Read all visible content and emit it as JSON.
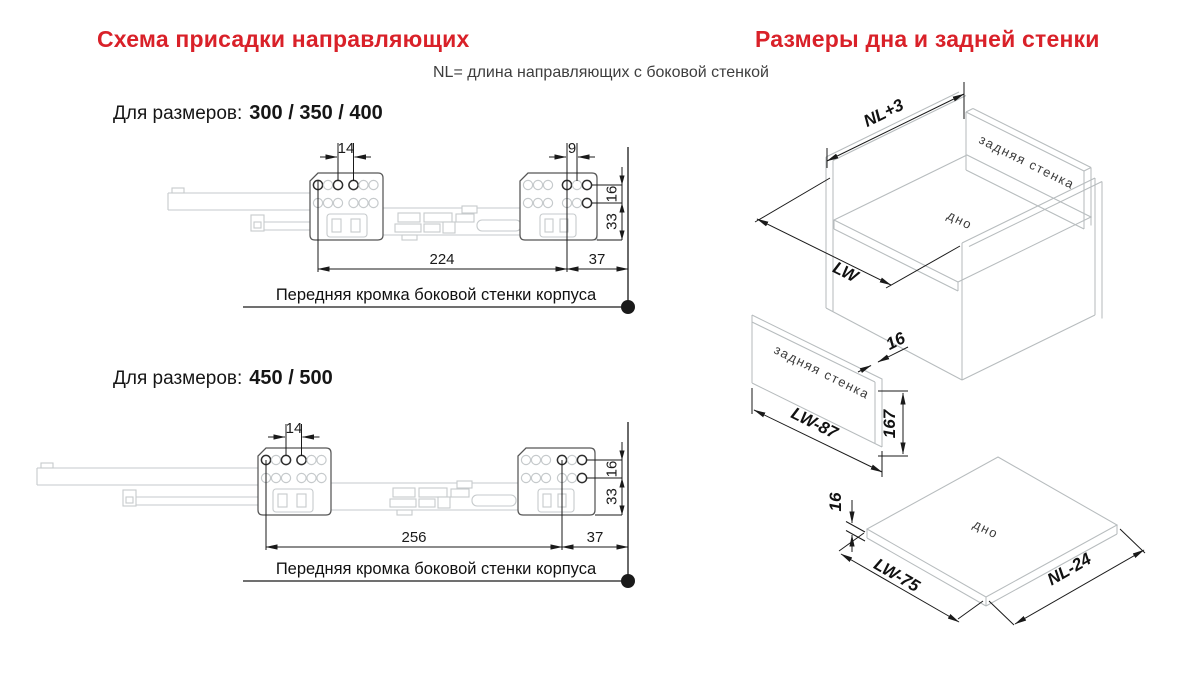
{
  "titles": {
    "left": "Схема присадки направляющих",
    "right": "Размеры дна и задней стенки",
    "subtitle": "NL= длина направляющих с боковой стенкой"
  },
  "colors": {
    "accent": "#d92129"
  },
  "drawing1": {
    "for_sizes_label": "Для размеров:",
    "for_sizes_values": "300 / 350 / 400",
    "edge_label": "Передняя кромка боковой стенки корпуса",
    "dims": {
      "front_hole_pitch": "14",
      "rear_hole_pitch": "9",
      "row_gap": "16",
      "bottom_gap": "33",
      "front_hole_distance": "224",
      "rear_offset": "37"
    }
  },
  "drawing2": {
    "for_sizes_label": "Для размеров:",
    "for_sizes_values": "450 / 500",
    "edge_label": "Передняя кромка боковой стенки корпуса",
    "dims": {
      "front_hole_pitch": "14",
      "row_gap": "16",
      "bottom_gap": "33",
      "front_hole_distance": "256",
      "rear_offset": "37"
    }
  },
  "cabinet": {
    "depth_dim": "NL+3",
    "width_dim": "LW",
    "back_wall_label": "задняя стенка",
    "bottom_label": "дно"
  },
  "back_panel": {
    "label": "задняя стенка",
    "width_dim": "LW-87",
    "height_dim": "167",
    "thickness_dim": "16"
  },
  "bottom_panel": {
    "label": "дно",
    "width_dim": "LW-75",
    "depth_dim": "NL-24",
    "thickness_dim": "16"
  }
}
